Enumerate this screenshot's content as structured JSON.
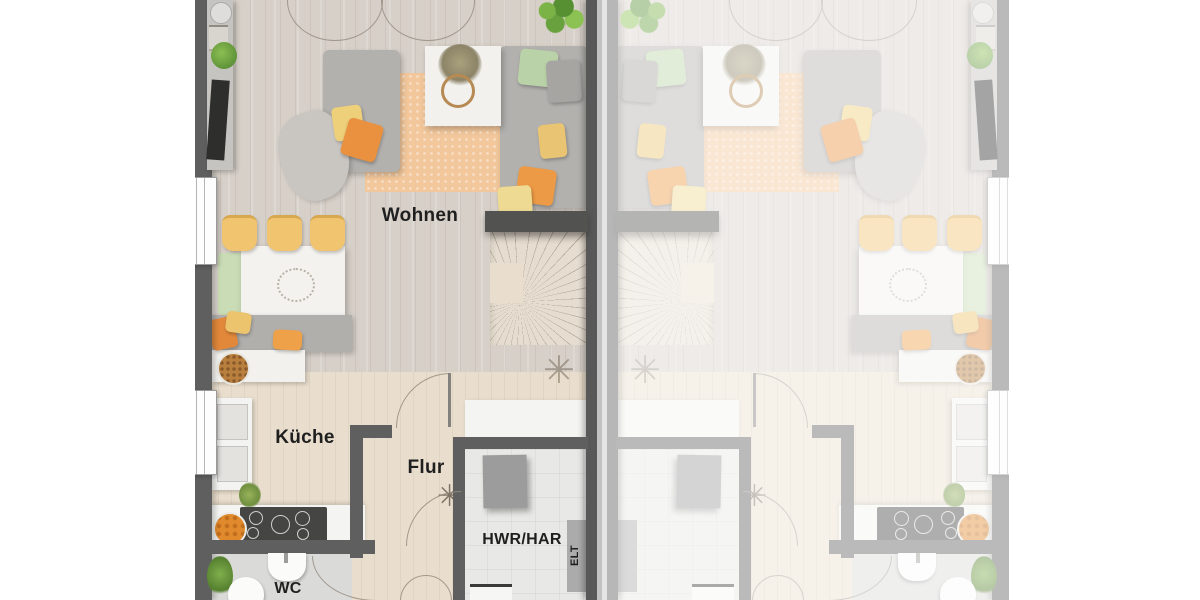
{
  "floorplan": {
    "type": "semi-detached-house-ground-floor",
    "labels": {
      "living": "Wohnen",
      "kitchen": "Küche",
      "hall": "Flur",
      "utility": "HWR/HAR",
      "electrical": "ELT",
      "wc": "WC"
    },
    "units": [
      {
        "id": "unit-left",
        "labeled": true
      },
      {
        "id": "unit-right",
        "labeled": false,
        "style": "faded mirror copy"
      }
    ],
    "colors": {
      "wall": "#5f5f5f",
      "living_floor": "#d7d0c9",
      "hall_floor": "#e9decd",
      "rug": "#f2c79b",
      "sofa": "#b3b1ae",
      "cushion_yellow": "#eecf7a",
      "cushion_orange": "#ea9140",
      "cushion_green": "#b9d2a7",
      "bench_green": "#c9dcb5",
      "chair_yellow": "#f1c46f",
      "label_text": "#1f1f1f"
    }
  }
}
